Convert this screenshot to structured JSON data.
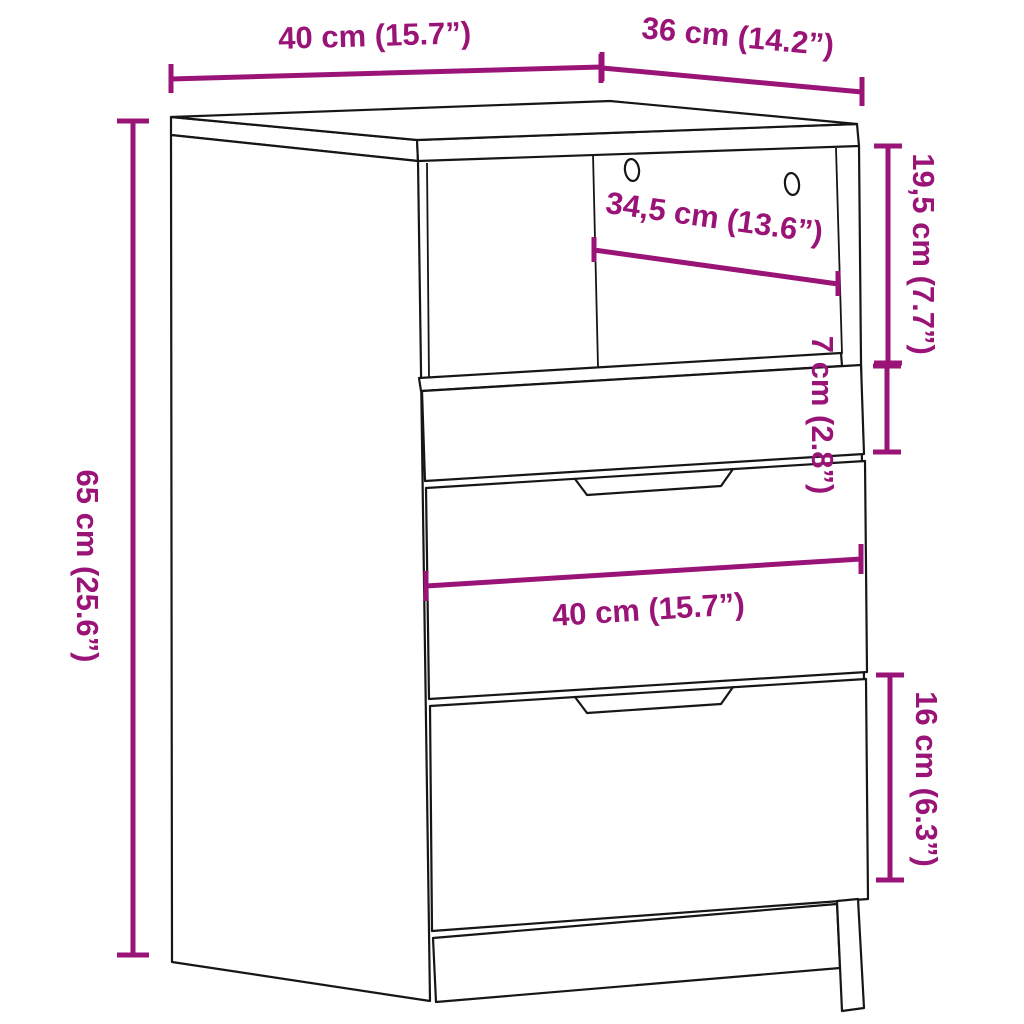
{
  "diagram": {
    "title": "Cabinet dimension diagram",
    "product": "Bedside cabinet with open shelf and three drawers",
    "accent_color": "#9a1477",
    "outline_color": "#161616",
    "labels": {
      "top_width": "40 cm (15.7”)",
      "top_depth": "36 cm (14.2”)",
      "compartment_height": "19,5 cm (7.7”)",
      "compartment_width": "34,5 cm (13.6”)",
      "small_drawer_height": "7 cm (2.8”)",
      "overall_height": "65 cm (25.6”)",
      "drawer_width": "40 cm (15.7”)",
      "bottom_drawer_height": "16 cm (6.3”)"
    }
  }
}
